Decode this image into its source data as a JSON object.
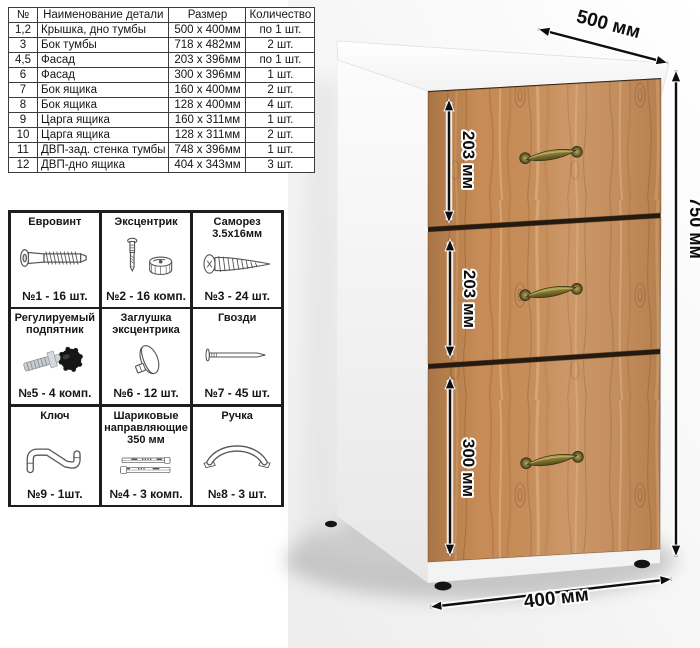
{
  "parts_table": {
    "headers": [
      "№",
      "Наименование детали",
      "Размер",
      "Количество"
    ],
    "rows": [
      [
        "1,2",
        "Крышка, дно тумбы",
        "500 х 400мм",
        "по 1 шт."
      ],
      [
        "3",
        "Бок тумбы",
        "718 х 482мм",
        "2 шт."
      ],
      [
        "4,5",
        "Фасад",
        "203 х 396мм",
        "по 1 шт."
      ],
      [
        "6",
        "Фасад",
        "300 х 396мм",
        "1 шт."
      ],
      [
        "7",
        "Бок ящика",
        "160 х 400мм",
        "2 шт."
      ],
      [
        "8",
        "Бок ящика",
        "128 х 400мм",
        "4 шт."
      ],
      [
        "9",
        "Царга ящика",
        "160 х 311мм",
        "1 шт."
      ],
      [
        "10",
        "Царга ящика",
        "128 х 311мм",
        "2 шт."
      ],
      [
        "11",
        "ДВП-зад. стенка тумбы",
        "748 х 396мм",
        "1 шт."
      ],
      [
        "12",
        "ДВП-дно ящика",
        "404 х 343мм",
        "3 шт."
      ]
    ]
  },
  "hardware_grid": {
    "cells": [
      {
        "title": "Евровинт",
        "qty": "№1 - 16 шт.",
        "icon": "euro-screw-icon"
      },
      {
        "title": "Эксцентрик",
        "qty": "№2 - 16 комп.",
        "icon": "cam-lock-icon"
      },
      {
        "title": "Саморез 3.5х16мм",
        "qty": "№3 - 24 шт.",
        "icon": "self-tapping-screw-icon"
      },
      {
        "title": "Регулируемый подпятник",
        "qty": "№5 - 4 комп.",
        "icon": "adjustable-foot-icon"
      },
      {
        "title": "Заглушка эксцентрика",
        "qty": "№6 - 12 шт.",
        "icon": "cam-cover-icon"
      },
      {
        "title": "Гвозди",
        "qty": "№7 - 45 шт.",
        "icon": "nail-icon"
      },
      {
        "title": "Ключ",
        "qty": "№9 - 1шт.",
        "icon": "hex-key-icon"
      },
      {
        "title": "Шариковые направляющие 350 мм",
        "qty": "№4 - 3 комп.",
        "icon": "ball-slides-icon"
      },
      {
        "title": "Ручка",
        "qty": "№8 - 3 шт.",
        "icon": "handle-icon"
      }
    ]
  },
  "cabinet": {
    "description": "Тумба с тремя ящиками, белый корпус, фасады дуб, бронзовые ручки",
    "dimensions": {
      "depth_label": "500 мм",
      "height_label": "750 мм",
      "width_label": "400 мм",
      "drawer_labels": [
        "203 мм",
        "203 мм",
        "300 мм"
      ]
    },
    "colors": {
      "wood": "#c78c57",
      "wood_dark": "#9c6236",
      "carcass": "#ffffff",
      "handle_bronze": "#7d7230",
      "feet": "#141414",
      "dimension": "#0e0e0e"
    }
  }
}
